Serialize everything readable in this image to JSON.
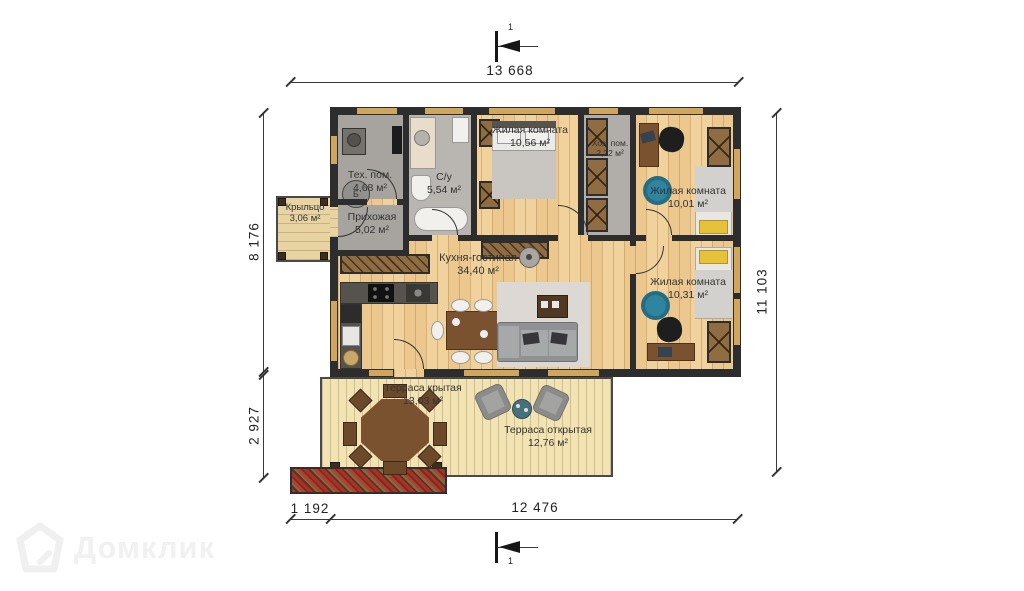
{
  "watermark": {
    "brand": "Домклик"
  },
  "section_marks": {
    "top": "1",
    "bottom": "1"
  },
  "dimensions": {
    "top": "13 668",
    "left_upper": "8 176",
    "left_lower": "2 927",
    "right": "11 103",
    "bottom_small": "1 192",
    "bottom_large": "12 476"
  },
  "rooms": [
    {
      "name": "Тех. пом.",
      "area": "4,68 м²"
    },
    {
      "name": "С/у",
      "area": "5,54 м²"
    },
    {
      "name": "Жилая комната",
      "area": "10,56 м²"
    },
    {
      "name": "Хоз. пом.",
      "area": "2,22 м²"
    },
    {
      "name": "Жилая комната",
      "area": "10,01 м²"
    },
    {
      "name": "Жилая комната",
      "area": "10,31 м²"
    },
    {
      "name": "Кухня-гостиная",
      "area": "34,40 м²"
    },
    {
      "name": "Прихожая",
      "area": "5,02 м²"
    },
    {
      "name": "Крыльцо",
      "area": "3,06 м²"
    },
    {
      "name": "Терраса крытая",
      "area": "13,03 м²"
    },
    {
      "name": "Терраса открытая",
      "area": "12,76 м²"
    }
  ],
  "fixtures": {
    "boiler_mark": "Б"
  },
  "colors": {
    "wall": "#2d2d2d",
    "floor_wood": "#ecc88e",
    "floor_terrace": "#f1e3b3",
    "window": "#d0a55e",
    "gray_room": "#a7a4a0",
    "accent_teal": "#2f84a0",
    "furniture_brown": "#7a5230"
  }
}
